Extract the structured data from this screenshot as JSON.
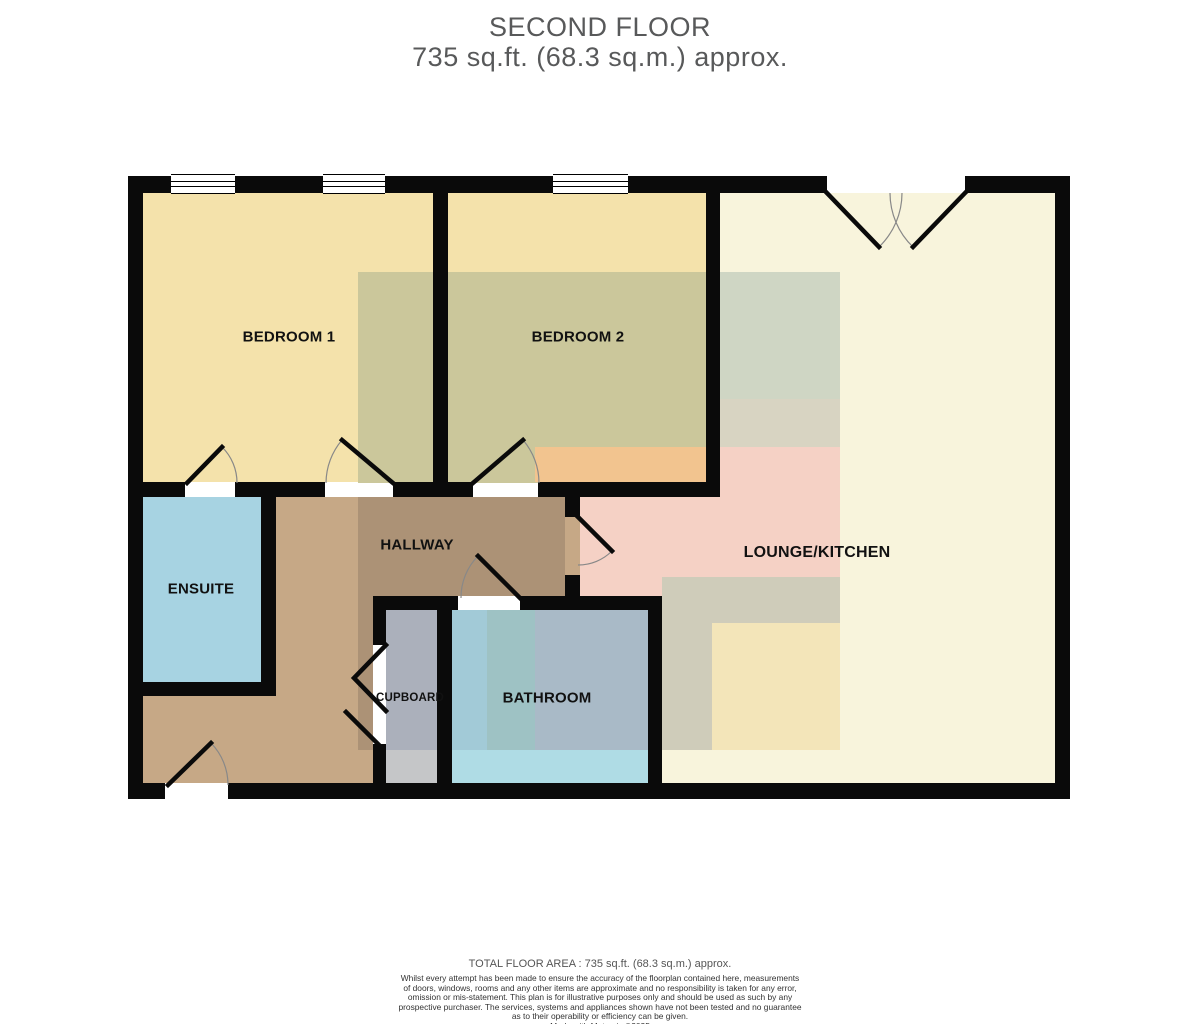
{
  "title": {
    "line1": "SECOND FLOOR",
    "line2": "735 sq.ft. (68.3 sq.m.) approx."
  },
  "rooms": {
    "bedroom1": {
      "label": "BEDROOM 1"
    },
    "bedroom2": {
      "label": "BEDROOM 2"
    },
    "lounge": {
      "label": "LOUNGE/KITCHEN"
    },
    "ensuite": {
      "label": "ENSUITE"
    },
    "hallway": {
      "label": "HALLWAY"
    },
    "cupboard": {
      "label": "CUPBOARD"
    },
    "bathroom": {
      "label": "BATHROOM"
    }
  },
  "footer": {
    "total_area": "TOTAL FLOOR AREA : 735 sq.ft. (68.3 sq.m.) approx.",
    "disclaimer_lines": [
      "Whilst every attempt has been made to ensure the accuracy of the floorplan contained here, measurements",
      "of doors, windows, rooms and any other items are approximate and no responsibility is taken for any error,",
      "omission or mis-statement. This plan is for illustrative purposes only and should be used as such by any",
      "prospective purchaser. The services, systems and appliances shown have not been tested and no guarantee",
      "as to their operability or efficiency can be given."
    ],
    "credit": "Made with Metropix ©2025"
  },
  "colors": {
    "wall": "#0a0a0a",
    "title-gray": "#58595A",
    "bedroom-cream": "#F4E2AB",
    "lounge-pale": "#F8F4DC",
    "ensuite-blue": "#A7D3E2",
    "hall-tan": "#C6A886",
    "hall-tan-dark": "#AC9276",
    "cupboard-gray": "#C5C6C8",
    "cupboard-gray-dark": "#ABB0BB",
    "bath-cyan": "#AFDCE5",
    "bath-strip-left": "#A2CAD7",
    "bath-strip-mid": "#9EC2C4",
    "bath-gray-blue": "#A9BAC7",
    "overlay-olive": "#CBC79B",
    "overlay-sage": "#CFD6C4",
    "overlay-tan": "#D8D4C2",
    "overlay-orange": "#F2C48F",
    "overlay-pink": "#F5D1C5",
    "overlay-grayband": "#CFCCBA",
    "overlay-yellow": "#F3E5B9"
  }
}
